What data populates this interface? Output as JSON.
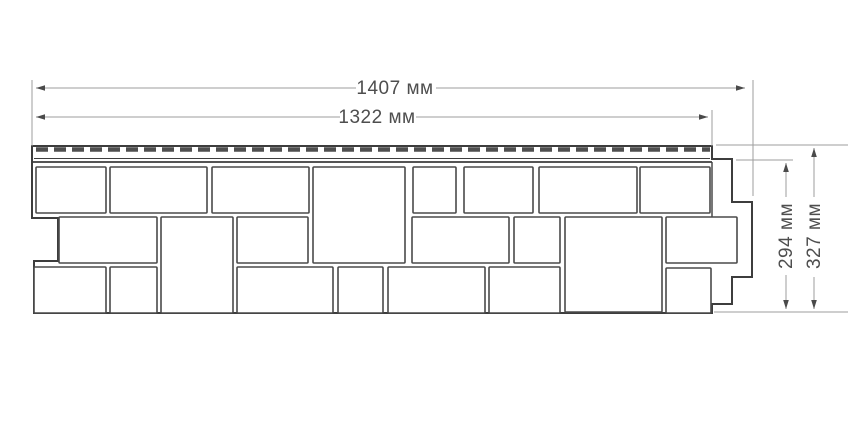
{
  "diagram": {
    "type": "technical-drawing",
    "subject": "facade-panel-profile-with-dimensions",
    "labels": {
      "width_total": "1407 мм",
      "width_inner": "1322 мм",
      "height_inner": "294 мм",
      "height_total": "327 мм"
    },
    "colors": {
      "background": "#ffffff",
      "outline": "#3d3d3d",
      "stone_border": "#4a4a4a",
      "dimension_line": "#9d9d9d",
      "arrow": "#4a4a4a",
      "text": "#4e4e4e",
      "nail_slot": "#4f4f4f"
    },
    "geometry": {
      "outline_path": "M 32 146 L 712 146 L 712 159 L 732 159 L 732 202 L 752 202 L 752 277 L 732 277 L 732 304 L 712 304 L 712 313 L 34 313 L 34 261 L 58 261 L 58 218 L 32 218 Z",
      "strip": {
        "dash_x1": 36,
        "dash_x2": 710,
        "dash_y": 149.5,
        "dash_width": 4.5,
        "dash_pattern": "12 6",
        "lines": [
          [
            34,
            158.5,
            710,
            158.5,
            1
          ],
          [
            32,
            162,
            712,
            162,
            1.8
          ],
          [
            712,
            162,
            712,
            217,
            1.4
          ]
        ]
      },
      "stones": [
        [
          36,
          167,
          70,
          46
        ],
        [
          110,
          167,
          97,
          46
        ],
        [
          212,
          167,
          97,
          46
        ],
        [
          313,
          167,
          92,
          96
        ],
        [
          413,
          167,
          43,
          46
        ],
        [
          464,
          167,
          69,
          46
        ],
        [
          539,
          167,
          98,
          46
        ],
        [
          640,
          167,
          70,
          46
        ],
        [
          59,
          217,
          98,
          46
        ],
        [
          161,
          217,
          72,
          96
        ],
        [
          237,
          217,
          71,
          46
        ],
        [
          412,
          217,
          97,
          46
        ],
        [
          514,
          217,
          46,
          46
        ],
        [
          565,
          217,
          97,
          95
        ],
        [
          666,
          217,
          71,
          46
        ],
        [
          34,
          267,
          72,
          46
        ],
        [
          110,
          267,
          47,
          46
        ],
        [
          237,
          267,
          96,
          46
        ],
        [
          338,
          267,
          45,
          46
        ],
        [
          388,
          267,
          97,
          46
        ],
        [
          489,
          267,
          71,
          46
        ],
        [
          666,
          268,
          45,
          45
        ]
      ],
      "ext_lines": [
        [
          32,
          80,
          32,
          146
        ],
        [
          753,
          80,
          753,
          196
        ],
        [
          712,
          110,
          712,
          146
        ],
        [
          716,
          145,
          848,
          145
        ],
        [
          736,
          160,
          793,
          160
        ],
        [
          714,
          312,
          848,
          312
        ]
      ],
      "dims": [
        {
          "x1": 36,
          "y1": 88,
          "x2": 745,
          "y2": 88
        },
        {
          "x1": 36,
          "y1": 117,
          "x2": 708,
          "y2": 117
        },
        {
          "x1": 786,
          "y1": 163,
          "x2": 786,
          "y2": 309
        },
        {
          "x1": 814,
          "y1": 148,
          "x2": 814,
          "y2": 309
        }
      ],
      "label_masks": [
        [
          356,
          79,
          80,
          18
        ],
        [
          340,
          108,
          76,
          18
        ],
        [
          777,
          197,
          18,
          78
        ],
        [
          805,
          197,
          18,
          80
        ]
      ]
    }
  }
}
